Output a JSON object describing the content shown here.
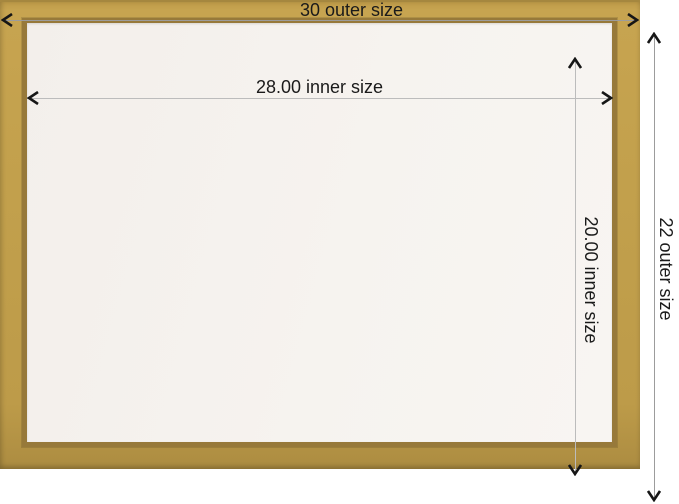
{
  "diagram": {
    "type": "picture-frame-size-diagram",
    "dimensions": {
      "outer_width": {
        "label": "30 outer size"
      },
      "outer_height": {
        "label": "22 outer size"
      },
      "inner_width": {
        "label": "28.00 inner size"
      },
      "inner_height": {
        "label": "20.00 inner size"
      }
    },
    "colors": {
      "frame_gold": "#c2a04c",
      "frame_gold_edge": "#a5873f",
      "frame_lip": "#97793a",
      "opening_white": "#f6f3ef",
      "dim_line_outer": "#9c9c9c",
      "dim_line_inner": "#bcbcbc",
      "text": "#1a1a1a",
      "background": "#ffffff"
    }
  }
}
